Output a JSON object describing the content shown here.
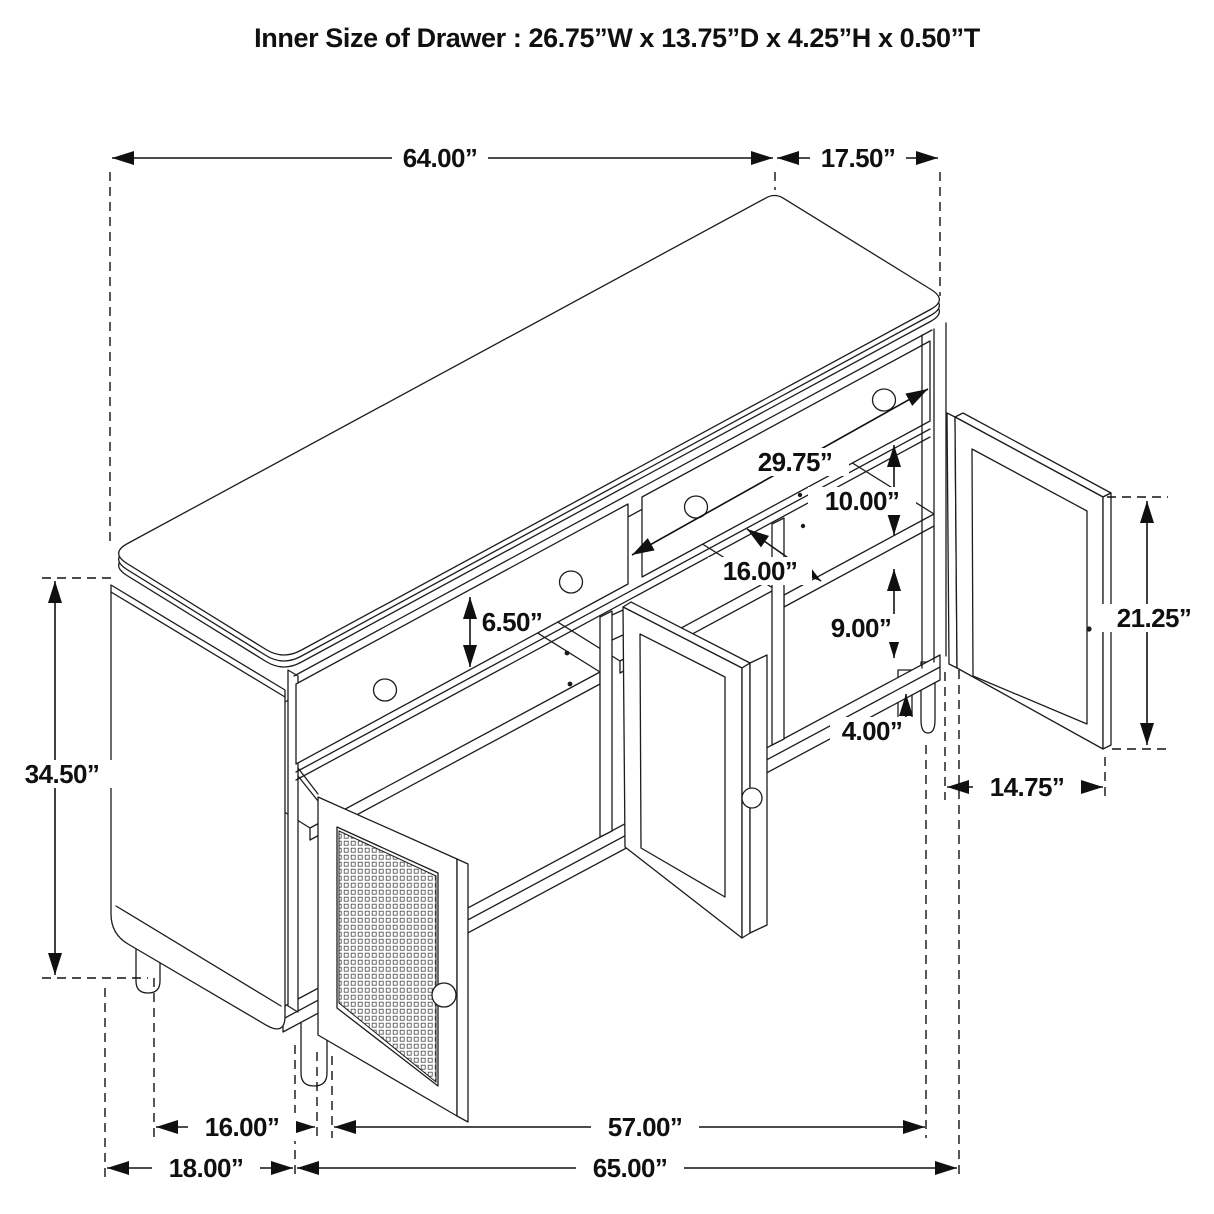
{
  "title": "Inner Size of Drawer  : 26.75”W x 13.75”D x 4.25”H x 0.50”T",
  "dimensions": {
    "top_length": "64.00”",
    "top_depth": "17.50”",
    "overall_height": "34.50”",
    "drawer_front_height": "6.50”",
    "drawer_width": "29.75”",
    "upper_opening_height": "10.00”",
    "shelf_depth": "16.00”",
    "lower_opening_height": "9.00”",
    "leg_height": "4.00”",
    "door_height": "21.25”",
    "door_width": "14.75”",
    "left_leg_span": "16.00”",
    "front_leg_span": "57.00”",
    "side_floor_width": "18.00”",
    "floor_length": "65.00”"
  },
  "colors": {
    "line": "#1c1c1c",
    "background": "#ffffff"
  }
}
